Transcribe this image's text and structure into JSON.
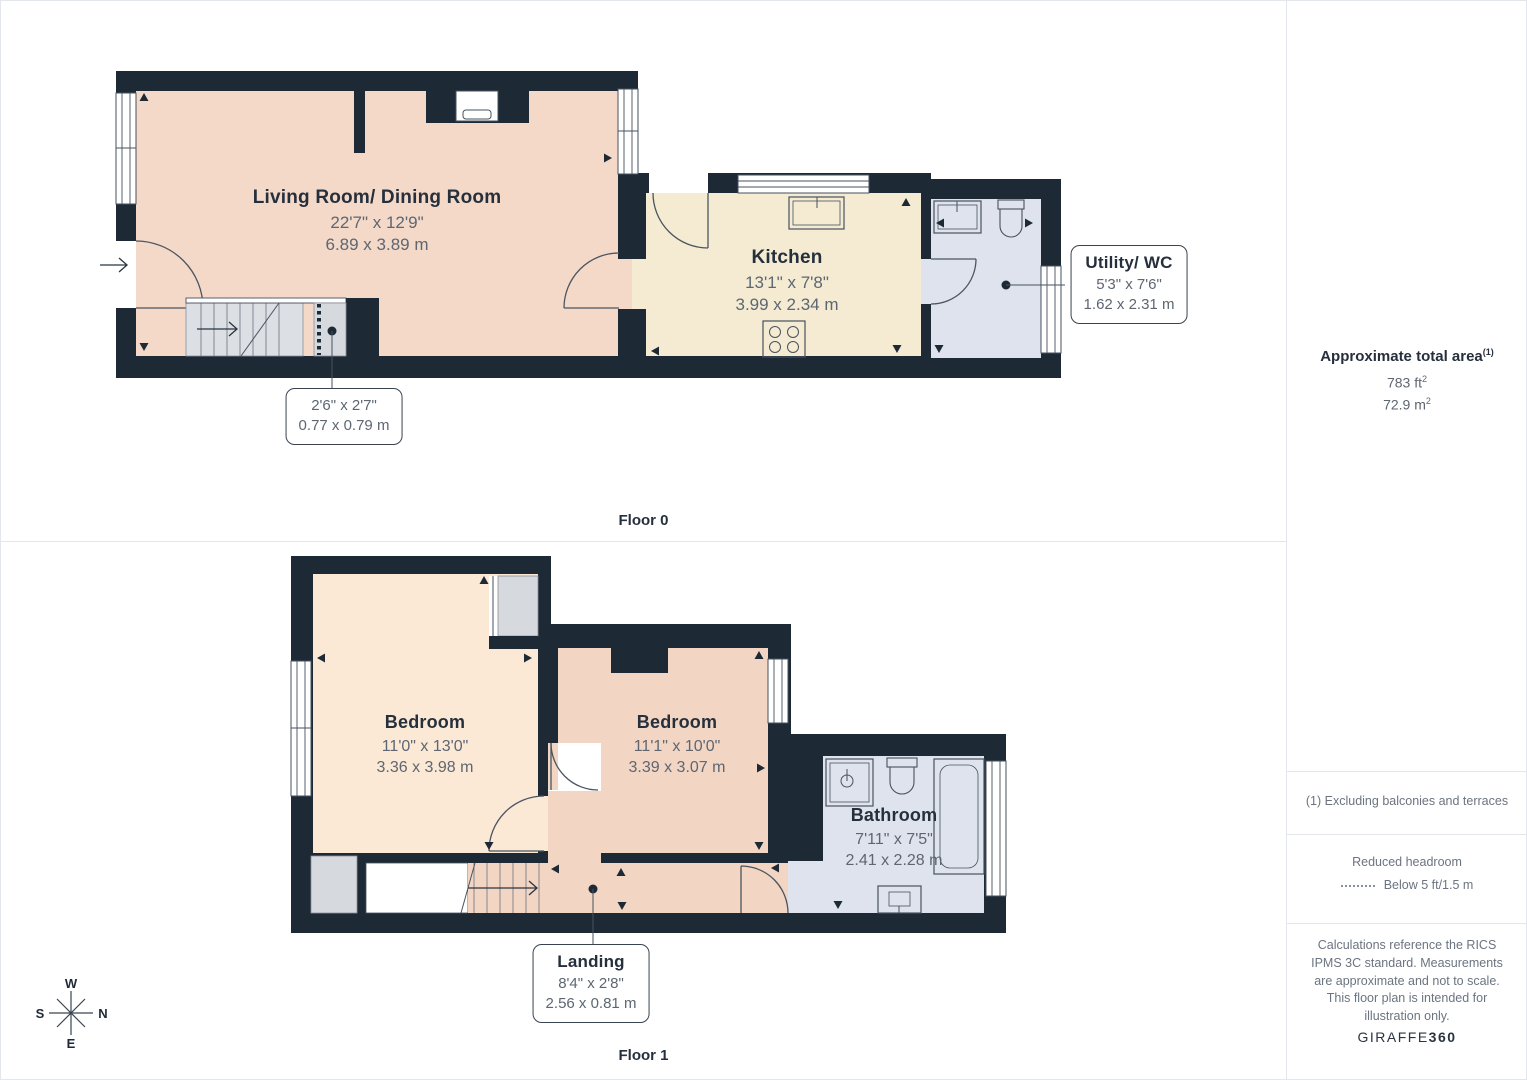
{
  "floor0": {
    "label": "Floor 0",
    "living": {
      "name": "Living Room/ Dining Room",
      "imperial": "22'7\" x 12'9\"",
      "metric": "6.89 x 3.89 m"
    },
    "kitchen": {
      "name": "Kitchen",
      "imperial": "13'1\" x 7'8\"",
      "metric": "3.99 x 2.34 m"
    },
    "utility": {
      "name": "Utility/ WC",
      "imperial": "5'3\" x 7'6\"",
      "metric": "1.62 x 2.31 m"
    },
    "cupboard": {
      "imperial": "2'6\" x 2'7\"",
      "metric": "0.77 x 0.79 m"
    }
  },
  "floor1": {
    "label": "Floor 1",
    "bedroom_left": {
      "name": "Bedroom",
      "imperial": "11'0\" x 13'0\"",
      "metric": "3.36 x 3.98 m"
    },
    "bedroom_right": {
      "name": "Bedroom",
      "imperial": "11'1\" x 10'0\"",
      "metric": "3.39 x 3.07 m"
    },
    "bathroom": {
      "name": "Bathroom",
      "imperial": "7'11\" x 7'5\"",
      "metric": "2.41 x 2.28 m"
    },
    "landing": {
      "name": "Landing",
      "imperial": "8'4\" x 2'8\"",
      "metric": "2.56 x 0.81 m"
    }
  },
  "sidebar": {
    "total_area_title": "Approximate total area",
    "total_area_sup": "(1)",
    "area_ft": "783 ft",
    "area_ft_sup": "2",
    "area_m": "72.9 m",
    "area_m_sup": "2",
    "footnote": "(1) Excluding balconies and terraces",
    "reduced_headroom_title": "Reduced headroom",
    "reduced_headroom_desc": "Below 5 ft/1.5 m",
    "disclaimer": "Calculations reference the RICS IPMS 3C standard. Measurements are approximate and not to scale. This floor plan is intended for illustration only.",
    "brand_left": "GIRAFFE",
    "brand_right": "360"
  },
  "compass": {
    "north": "N",
    "south": "S",
    "east": "E",
    "west": "W"
  },
  "colors": {
    "wall": "#1e2936",
    "living_fill": "#f5d9c8",
    "kitchen_fill": "#f4ebd2",
    "wet_room_fill": "#dfe3ed",
    "bedroom_left_fill": "#fbe9d6",
    "bedroom_right_fill": "#f2d5c2",
    "closet_fill": "#d6d9de",
    "outline": "#47525f"
  }
}
